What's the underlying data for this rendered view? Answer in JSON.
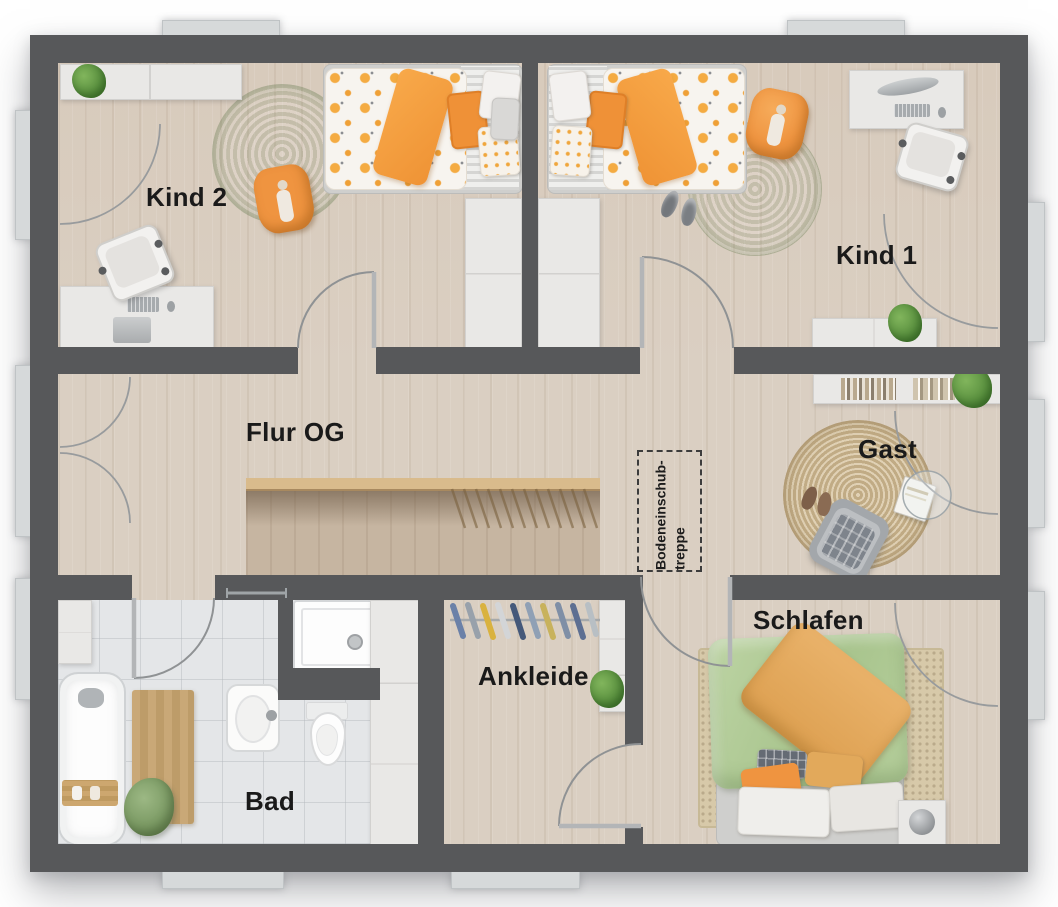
{
  "plan": {
    "type": "floor-plan",
    "rooms": [
      {
        "id": "kind2",
        "label": "Kind 2"
      },
      {
        "id": "kind1",
        "label": "Kind 1"
      },
      {
        "id": "flur",
        "label": "Flur OG"
      },
      {
        "id": "gast",
        "label": "Gast"
      },
      {
        "id": "schlafen",
        "label": "Schlafen"
      },
      {
        "id": "ankleide",
        "label": "Ankleide"
      },
      {
        "id": "bad",
        "label": "Bad"
      }
    ],
    "annotations": {
      "attic_stairs_line1": "Bodeneinschub-",
      "attic_stairs_line2": "treppe"
    },
    "palette": {
      "wall": "#57585a",
      "floor_wood": "#dacfc2",
      "floor_tile": "#e4e6e8",
      "stair_void": "#c6b5a1",
      "window_glass": "#d3e9f4",
      "accent_orange": "#ef9440",
      "accent_green": "#a9c48b",
      "duvet_green": "#b5cd9b",
      "jute": "#d5c19b",
      "door_arc": "#8f9294"
    }
  }
}
